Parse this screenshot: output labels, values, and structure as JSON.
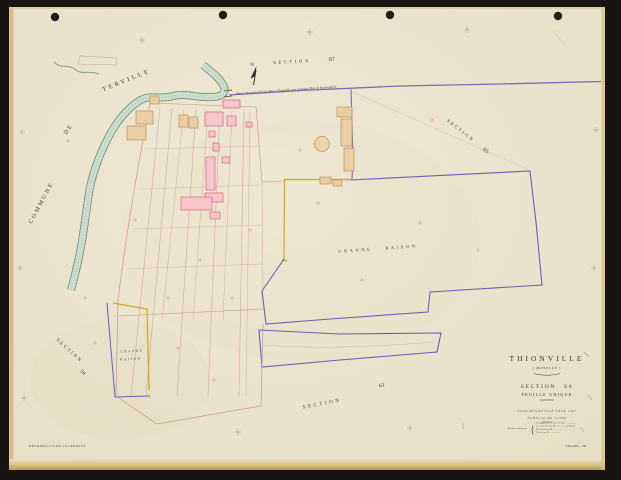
{
  "labels": {
    "commune": "COMMUNE",
    "de": "DE",
    "terville": "TERVILLE",
    "north": "N",
    "section67_word": "SECTION",
    "section67_num": "67",
    "section65_word": "SECTION",
    "section65_num": "65",
    "section59_word": "SECTION",
    "section59_num": "59",
    "section61_word": "SECTION",
    "section61_num": "61",
    "grande_raison": "GRANDE RAISON",
    "grande_small_1": "GRANDE",
    "grande_small_2": "RAISON",
    "road_name": "Route nationale n°53 de Metz à Thionville par Uckange (Rue de Beauregard)"
  },
  "title_block": {
    "commune": "THIONVILLE",
    "department": "( MOSELLE )",
    "section": "SECTION 66",
    "sheet": "FEUILLE UNIQUE",
    "plan_note": "PLAN RENOUVELÉ POUR 1947",
    "scale_note": "ÉCHELLE DE 1/2000",
    "works_label": "Travaux cadastraux",
    "works_lines": [
      "Triangulation exécutée par M. ————",
      "Levé exécuté par M. ———— géomètre",
      "Mis à jour par M. ————",
      "Vérifié par M. ————"
    ],
    "brace": "{"
  },
  "footer": {
    "left": "REPRODUCTION INTERDITE",
    "right": "Thionville — 66"
  },
  "colors": {
    "paper": "#ebe4cf",
    "scan_background": "#171411",
    "stream_edge_green": "#6f9671",
    "stream_fill": "#cfdccd",
    "boundary_purple": "#6b60ae",
    "road_purple": "#7a6cb5",
    "boundary_yellow": "#d8a31f",
    "building_pink": "#f6c6cb",
    "building_pink_outline": "#cd6c77",
    "building_tan": "#e9cda4",
    "building_tan_outline": "#bd9258",
    "parcel_red": "#d19090",
    "ink": "#3a352c"
  }
}
